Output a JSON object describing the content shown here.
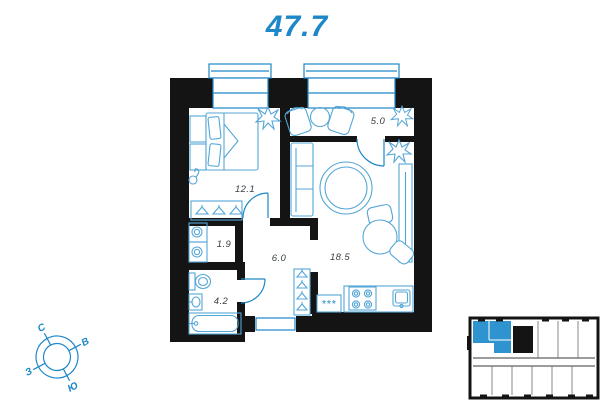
{
  "apartment": {
    "total_area": "47.7"
  },
  "plan": {
    "rooms": {
      "bedroom": {
        "area": "12.1"
      },
      "balcony": {
        "area": "5.0"
      },
      "living_kitchen": {
        "area": "18.5"
      },
      "hallway": {
        "area": "6.0"
      },
      "storage": {
        "area": "1.9"
      },
      "bathroom": {
        "area": "4.2"
      }
    },
    "appliance_placeholder": "***"
  },
  "compass": {
    "north": "С",
    "east": "В",
    "south": "Ю",
    "west": "З"
  },
  "colors": {
    "accent": "#1d87c8",
    "furniture": "#54a6d6",
    "wall": "#141414",
    "minimap_highlight": "#2f93d0"
  }
}
